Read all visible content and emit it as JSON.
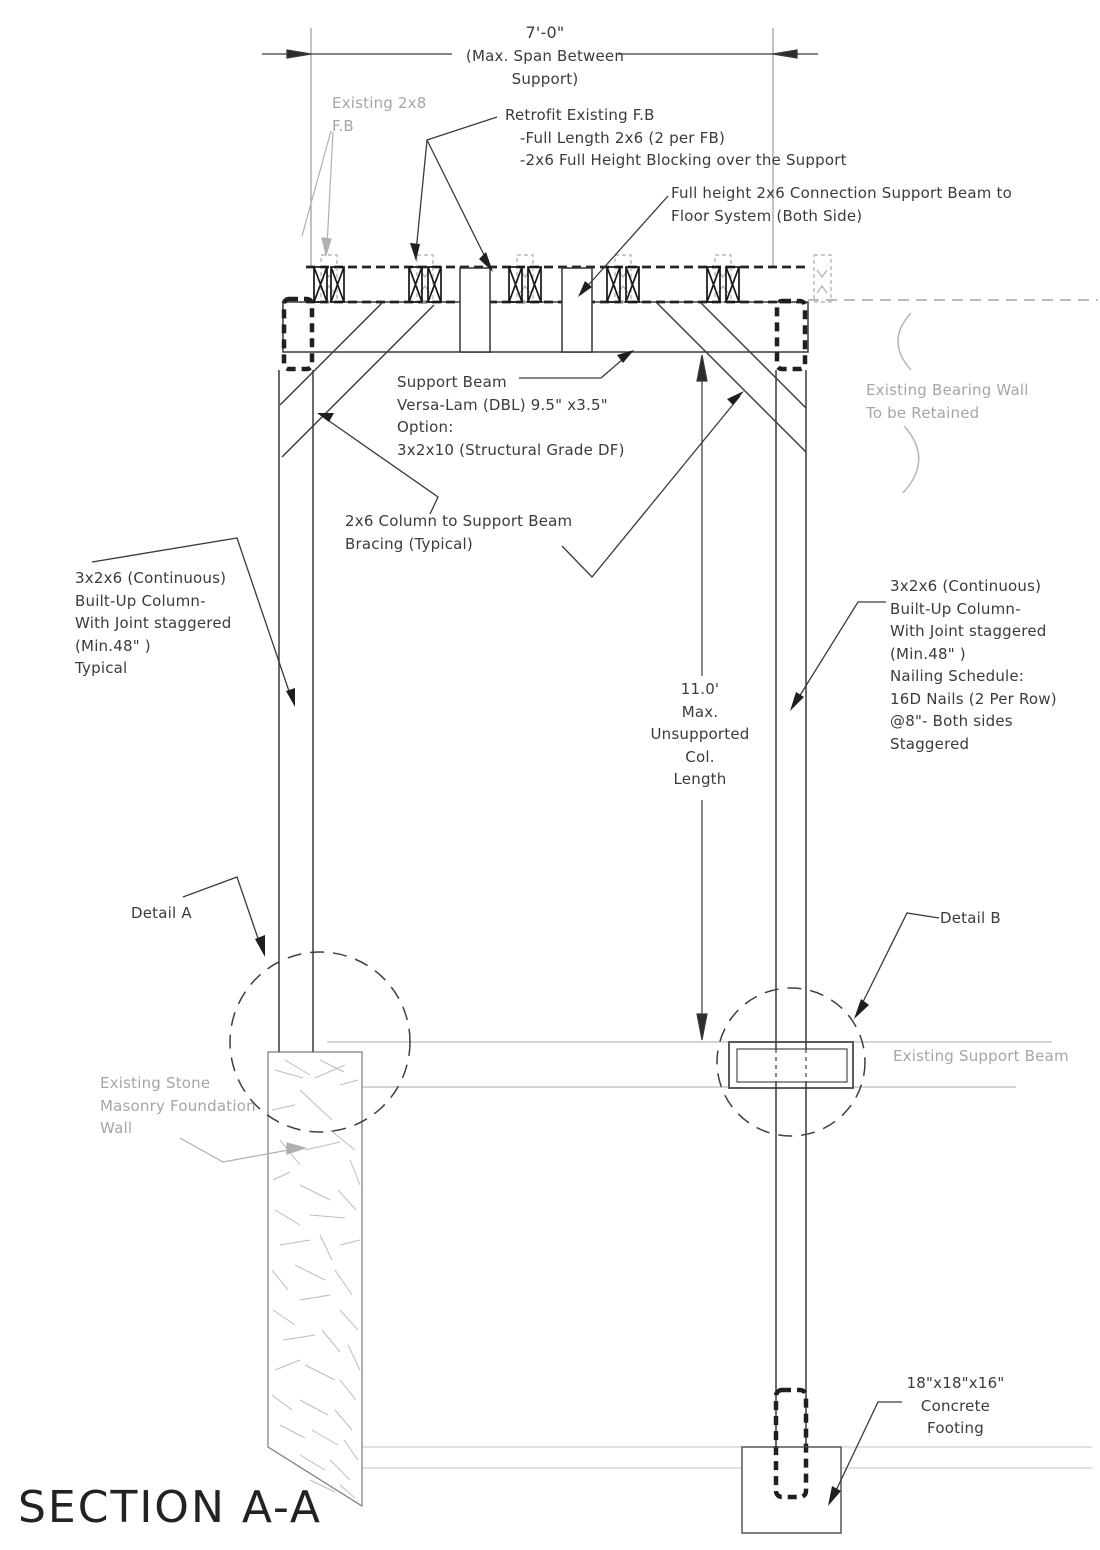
{
  "drawing": {
    "title": "SECTION A-A",
    "dimension_top": {
      "value": "7'-0\"",
      "note": "(Max. Span Between\nSupport)"
    },
    "labels": {
      "existing_fb": "Existing 2x8\nF.B",
      "retrofit": "Retrofit Existing F.B\n   -Full Length 2x6 (2 per FB)\n   -2x6 Full Height Blocking over the Support",
      "full_height_connection": "Full height 2x6 Connection Support Beam to\nFloor System (Both Side)",
      "support_beam": "Support Beam\nVersa-Lam (DBL) 9.5\" x3.5\"\nOption:\n3x2x10 (Structural Grade DF)",
      "bracing": "2x6 Column to Support Beam\nBracing (Typical)",
      "built_up_column_left": "3x2x6 (Continuous)\nBuilt-Up Column-\nWith Joint staggered\n(Min.48\" )\nTypical",
      "built_up_column_right": "3x2x6 (Continuous)\nBuilt-Up Column-\nWith Joint staggered\n(Min.48\" )\nNailing Schedule:\n16D Nails (2 Per Row)\n@8\"- Both sides\nStaggered",
      "bearing_wall": "Existing Bearing Wall\nTo be Retained",
      "unsupported_length": "11.0'\nMax.\nUnsupported\nCol.\nLength",
      "detail_a": "Detail A",
      "detail_b": "Detail B",
      "existing_support_beam": "Existing Support Beam",
      "stone_wall": "Existing Stone\nMasonry Foundation\nWall",
      "concrete_footing": "18\"x18\"x16\"\nConcrete\nFooting"
    },
    "colors": {
      "ink": "#3a3a3a",
      "existing_gray": "#a8a8a8",
      "slab_gray": "#c9c9c9"
    }
  }
}
